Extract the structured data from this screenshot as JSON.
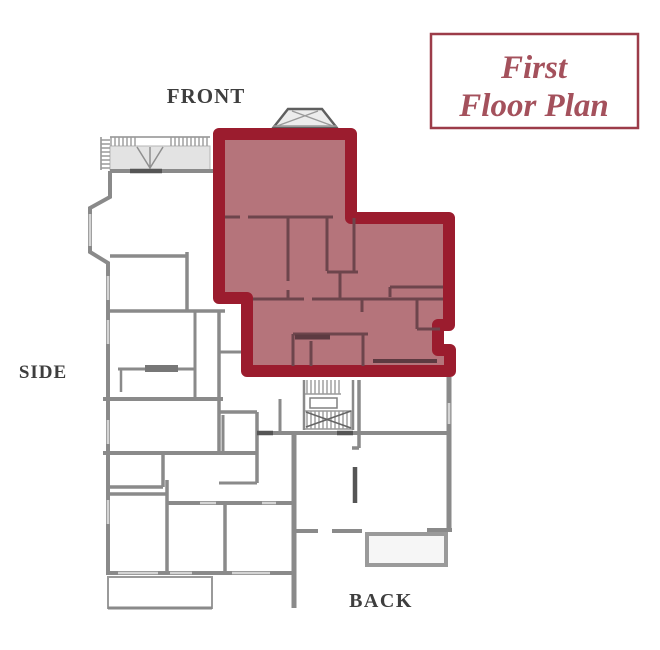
{
  "title_box": {
    "line1": "First",
    "line2": "Floor Plan"
  },
  "labels": {
    "front": "FRONT",
    "side": "SIDE",
    "back": "BACK"
  },
  "highlight": {
    "unit": "first-floor-unit",
    "fill": "#b5747b",
    "border": "#9b1c2e"
  },
  "colors": {
    "interior_unit_wall": "#6d454c",
    "wall_gray": "#8a8a8a",
    "wall_dark": "#555555",
    "porch_fill": "#e3e3e3",
    "bay_fill": "#ececec",
    "title_text": "#a4515c",
    "title_border": "#9c3c49",
    "label_text": "#3e3e3e",
    "background": "#ffffff"
  }
}
